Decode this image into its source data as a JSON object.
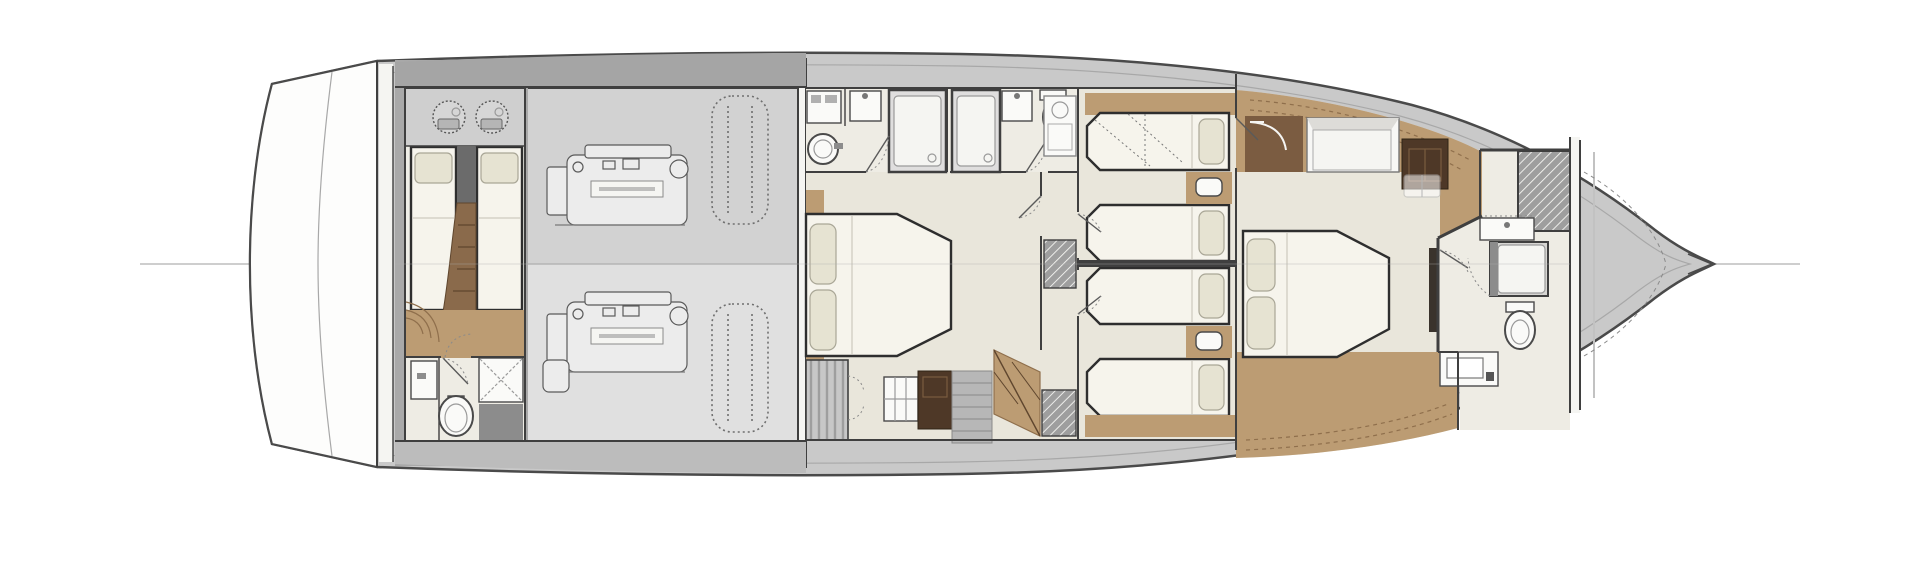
{
  "meta": {
    "type": "floorplan",
    "subject": "motor-yacht-lower-deck",
    "view": "top-down",
    "orientation": "bow-right",
    "visible_text": []
  },
  "canvas": {
    "width": 1920,
    "height": 561
  },
  "palette": {
    "background": "#ffffff",
    "hull_outline": "#4a4a4a",
    "hull_inner_line": "#a8a8a8",
    "deck": "#c9c9c9",
    "deck_dark": "#a9a9a9",
    "deck_light": "#cfcfcf",
    "platform": "#fdfdfc",
    "engine_floor_top": "#d2d2d2",
    "engine_floor_bottom": "#e0e0e0",
    "cabin_floor": "#e9e6db",
    "bath_floor": "#eeece4",
    "wood": "#bc9c73",
    "wood_dark": "#8f6f4c",
    "walkway_brown": "#7b5c41",
    "furniture_brown": "#4e3827",
    "wall": "#3f3f3f",
    "wall_white": "#f5f5f2",
    "bed_fill": "#f6f4ec",
    "bed_stroke": "#2e2e2e",
    "pillow_fill": "#e6e3d2",
    "pillow_stroke": "#a9a696",
    "fixture_fill": "#fafaf8",
    "fixture_stroke": "#4a4a4a",
    "hatch_fill": "#9e9e9e",
    "gray_block": "#8c8c8c",
    "steps_gray": "#b7b7b7",
    "centerline": "#b0b0b0",
    "machinery": "#ececec",
    "machinery_stroke": "#5a5a5a",
    "tank_outline": "#6f6f6f"
  },
  "rooms": [
    {
      "id": "swim-platform",
      "features": []
    },
    {
      "id": "crew-cabin",
      "features": [
        "single-berth",
        "single-berth",
        "round-seat",
        "round-seat",
        "ladder",
        "wood-sole-steps"
      ]
    },
    {
      "id": "crew-bathroom",
      "features": [
        "sink",
        "toilet",
        "shower"
      ]
    },
    {
      "id": "engine-room",
      "features": [
        "engine-port",
        "engine-starboard",
        "tank-port",
        "tank-starboard"
      ]
    },
    {
      "id": "vip-cabin",
      "features": [
        "double-berth",
        "wardrobe",
        "cabinet",
        "staircase"
      ]
    },
    {
      "id": "vip-bathroom",
      "features": [
        "round-sink",
        "vanity-sink",
        "shower",
        "cabinet"
      ]
    },
    {
      "id": "guest-shower-room",
      "features": [
        "shower",
        "vanity-sink",
        "toilet"
      ]
    },
    {
      "id": "corridor",
      "features": [
        "washer-unit",
        "hatched-cabinet",
        "staircase"
      ]
    },
    {
      "id": "guest-cabin-port",
      "features": [
        "single-berth",
        "single-berth",
        "nightstand",
        "wood-shelf"
      ]
    },
    {
      "id": "guest-cabin-starboard",
      "features": [
        "single-berth",
        "single-berth",
        "nightstand",
        "wood-shelf"
      ]
    },
    {
      "id": "master-cabin",
      "features": [
        "double-berth",
        "entry-walkway",
        "vanity-dresser",
        "dark-cabinet",
        "stool",
        "tv-panel"
      ]
    },
    {
      "id": "master-bathroom",
      "features": [
        "shower",
        "hatched-locker",
        "sink-counter",
        "toilet",
        "sink-counter-aft"
      ]
    },
    {
      "id": "bow-anchor-locker",
      "features": [
        "anchor-locker-dashes",
        "bow-fitting"
      ]
    }
  ]
}
